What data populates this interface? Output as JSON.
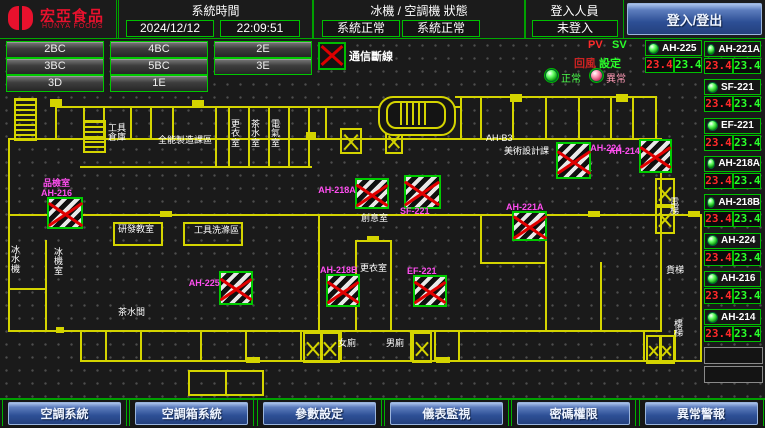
{
  "header": {
    "logo_title": "宏亞食品",
    "logo_subtitle": "HUNYA FOODS",
    "system_time_label": "系統時間",
    "date": "2024/12/12",
    "time": "22:09:51",
    "status_label": "冰機 / 空調機 狀態",
    "chiller_status": "系統正常",
    "ahu_status": "系統正常",
    "login_label": "登入人員",
    "login_status": "未登入",
    "login_button": "登入/登出"
  },
  "zone_buttons": [
    "2BC",
    "4BC",
    "2E",
    "3BC",
    "5BC",
    "3E",
    "3D",
    "1E"
  ],
  "legend": {
    "comm_loss": "通信斷線",
    "pv": "PV",
    "sv": "SV",
    "pv_col": "回風",
    "sv_col": "設定",
    "normal": "正常",
    "abnormal": "異常"
  },
  "colors": {
    "accent_green": "#00c000",
    "alarm_red": "#dd0000",
    "magenta_label": "#ff4ef0",
    "wall_yellow": "#d4d400",
    "brand_red": "#e8112d"
  },
  "units_left": [
    {
      "name": "AH-225",
      "pv": "23.4",
      "sv": "23.4"
    }
  ],
  "units_right": [
    {
      "name": "AH-221A",
      "pv": "23.4",
      "sv": "23.4"
    },
    {
      "name": "SF-221",
      "pv": "23.4",
      "sv": "23.4"
    },
    {
      "name": "EF-221",
      "pv": "23.4",
      "sv": "23.4"
    },
    {
      "name": "AH-218A",
      "pv": "23.4",
      "sv": "23.4"
    },
    {
      "name": "AH-218B",
      "pv": "23.4",
      "sv": "23.4"
    },
    {
      "name": "AH-224",
      "pv": "23.4",
      "sv": "23.4"
    },
    {
      "name": "AH-216",
      "pv": "23.4",
      "sv": "23.4"
    },
    {
      "name": "AH-214",
      "pv": "23.4",
      "sv": "23.4"
    }
  ],
  "map": {
    "markers": [
      {
        "x": 47,
        "y": 197,
        "w": 32,
        "h": 28,
        "label": "品檢室\nAH-216",
        "pos": "above"
      },
      {
        "x": 355,
        "y": 178,
        "w": 30,
        "h": 27,
        "label": "AH-218A",
        "pos": "left"
      },
      {
        "x": 404,
        "y": 175,
        "w": 33,
        "h": 30,
        "label": "SF-221",
        "pos": "below"
      },
      {
        "x": 556,
        "y": 142,
        "w": 31,
        "h": 33,
        "label": "AH-224",
        "pos": "right"
      },
      {
        "x": 639,
        "y": 139,
        "w": 29,
        "h": 30,
        "label": "AH-214",
        "pos": "left"
      },
      {
        "x": 512,
        "y": 211,
        "w": 31,
        "h": 26,
        "label": "AH-221A",
        "pos": "above"
      },
      {
        "x": 219,
        "y": 271,
        "w": 30,
        "h": 30,
        "label": "AH-225",
        "pos": "left"
      },
      {
        "x": 326,
        "y": 274,
        "w": 30,
        "h": 29,
        "label": "AH-218B",
        "pos": "above"
      },
      {
        "x": 413,
        "y": 275,
        "w": 30,
        "h": 28,
        "label": "EF-221",
        "pos": "above"
      }
    ],
    "room_labels": [
      {
        "x": 108,
        "y": 124,
        "t": "工具\n倉庫"
      },
      {
        "x": 158,
        "y": 136,
        "t": "全能製造課區"
      },
      {
        "x": 231,
        "y": 120,
        "t": "更\n衣\n室"
      },
      {
        "x": 251,
        "y": 120,
        "t": "茶\n水\n室"
      },
      {
        "x": 271,
        "y": 120,
        "t": "電\n氣\n室"
      },
      {
        "x": 486,
        "y": 134,
        "t": "AH-B3"
      },
      {
        "x": 504,
        "y": 147,
        "t": "美術設計課"
      },
      {
        "x": 556,
        "y": 163,
        "t": "工藝教室"
      },
      {
        "x": 640,
        "y": 164,
        "t": "烘焙室"
      },
      {
        "x": 54,
        "y": 248,
        "t": "冰\n機\n室"
      },
      {
        "x": 11,
        "y": 246,
        "t": "冰\n水\n機"
      },
      {
        "x": 118,
        "y": 225,
        "t": "研發教室"
      },
      {
        "x": 194,
        "y": 226,
        "t": "工具洗滌區"
      },
      {
        "x": 361,
        "y": 214,
        "t": "創意室"
      },
      {
        "x": 360,
        "y": 264,
        "t": "更衣室"
      },
      {
        "x": 338,
        "y": 339,
        "t": "女廁"
      },
      {
        "x": 386,
        "y": 339,
        "t": "男廁"
      },
      {
        "x": 118,
        "y": 308,
        "t": "茶水間"
      },
      {
        "x": 670,
        "y": 198,
        "t": "電\n梯"
      },
      {
        "x": 666,
        "y": 266,
        "t": "貨梯"
      },
      {
        "x": 674,
        "y": 320,
        "t": "樓\n梯"
      }
    ]
  },
  "nav_buttons": [
    "空調系統",
    "空調箱系統",
    "參數設定",
    "儀表監視",
    "密碼權限",
    "異常警報"
  ]
}
